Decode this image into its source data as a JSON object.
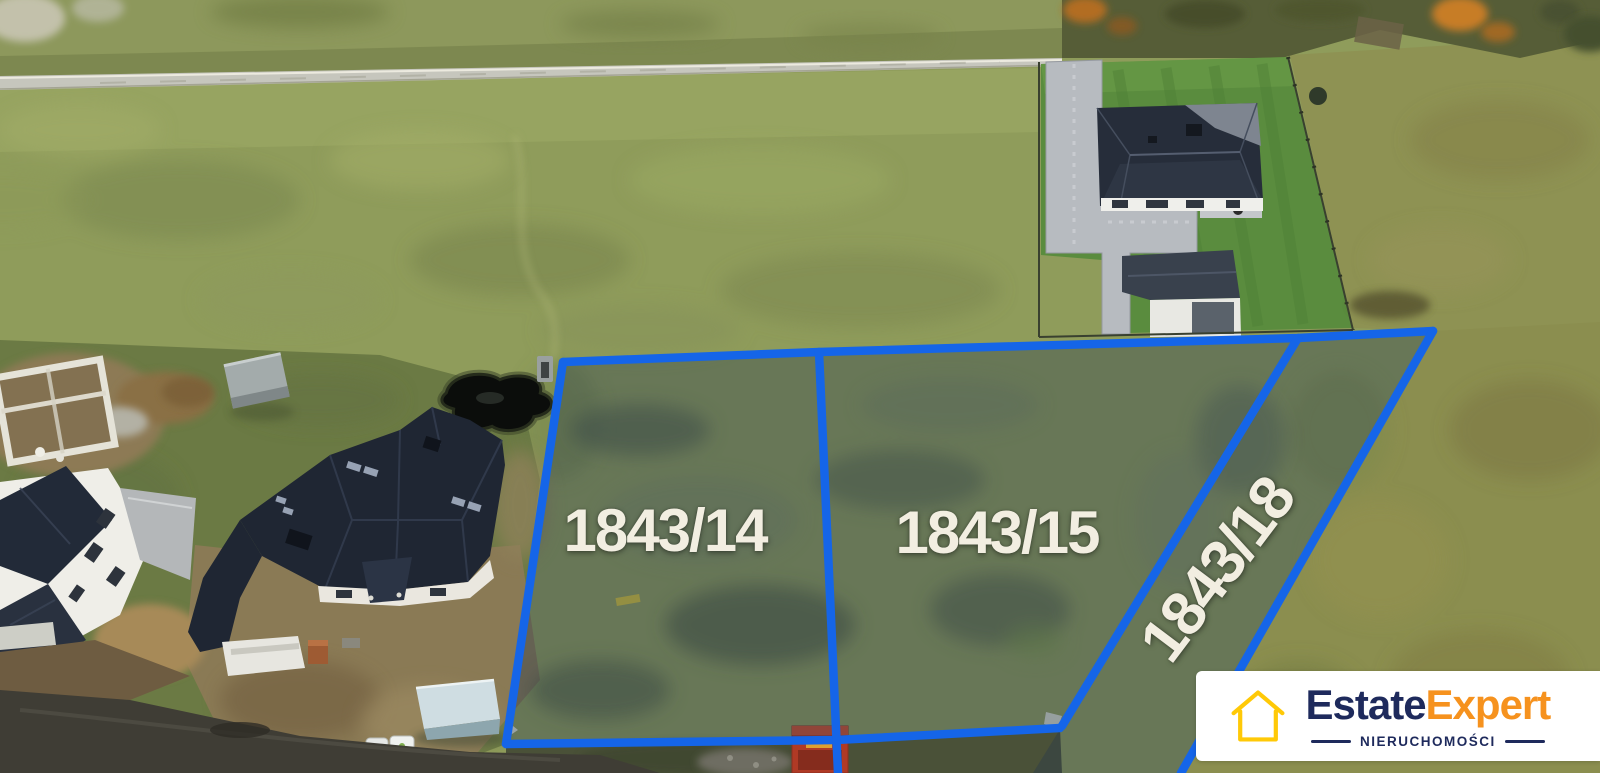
{
  "plots": [
    {
      "label": "1843/14"
    },
    {
      "label": "1843/15"
    },
    {
      "label": "1843/18"
    }
  ],
  "branding": {
    "logo_text_primary": "Estate",
    "logo_text_secondary": "Expert",
    "tagline": "NIERUCHOMOŚCI",
    "icon": "house-outline-icon"
  },
  "colors": {
    "boundary-blue": "#1565e8",
    "brand-navy": "#1e2a5c",
    "brand-orange": "#f6921e",
    "brand-yellow": "#ffc907",
    "label-cream": "#f2eee1",
    "logo-bg": "#ffffff"
  }
}
